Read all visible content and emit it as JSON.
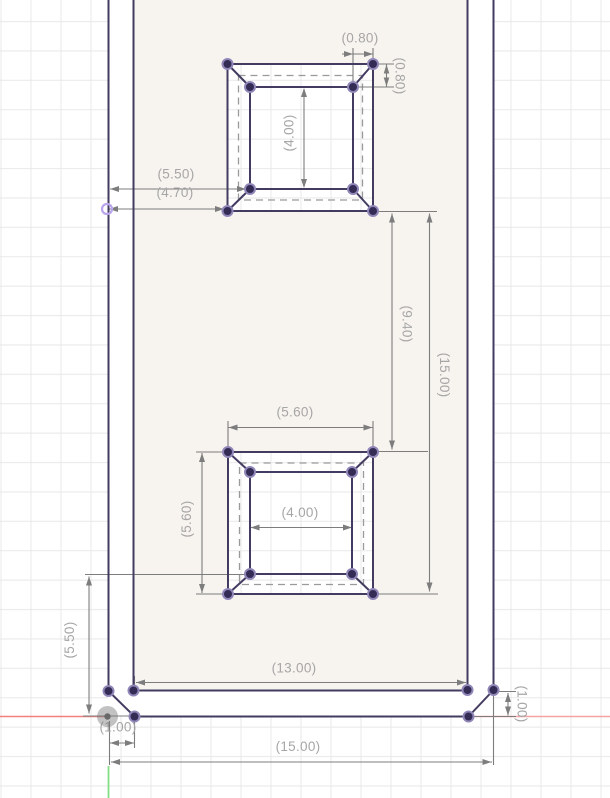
{
  "app": {
    "view": "cad-sketch-canvas",
    "description": "Parametric sketch of a tall rectangular part with two square cutouts, driven (reference) dimensions shown in parentheses"
  },
  "canvas": {
    "width_px": 610,
    "height_px": 798,
    "background": "#ffffff",
    "grid_color": "#e8e8e8",
    "profile_tint": "#f7f4f0"
  },
  "axes": {
    "x_axis_color_left": "#f37f7f",
    "x_axis_color_right": "#f2a4a4",
    "y_axis_color": "#84de84"
  },
  "sketch": {
    "line_color": "#433b60",
    "point_fill": "#342c55",
    "point_ring": "#9087b8",
    "construction_color": "#9a9a9a",
    "highlight_point_color": "#b9a5ec",
    "origin_fill": "rgba(120,120,120,0.45)",
    "origin_dot": "#696969"
  },
  "dimensions": {
    "line_color": "#7d7d7d",
    "text_color": "#a6a6a6",
    "labels": {
      "ts_offset_top": "(0.80)",
      "ts_offset_right": "(0.80)",
      "ts_inner_height": "(4.00)",
      "edge_to_inner": "(5.50)",
      "edge_to_outer": "(4.70)",
      "square_gap": "(9.40)",
      "squares_extent": "(15.00)",
      "bs_outer_width": "(5.60)",
      "bs_outer_height": "(5.60)",
      "bs_inner_width": "(4.00)",
      "bs_to_bottom": "(5.50)",
      "cavity_width": "(13.00)",
      "wall_left": "(1.00)",
      "overall_width": "(15.00)",
      "wall_bottom": "(1.00)"
    }
  }
}
